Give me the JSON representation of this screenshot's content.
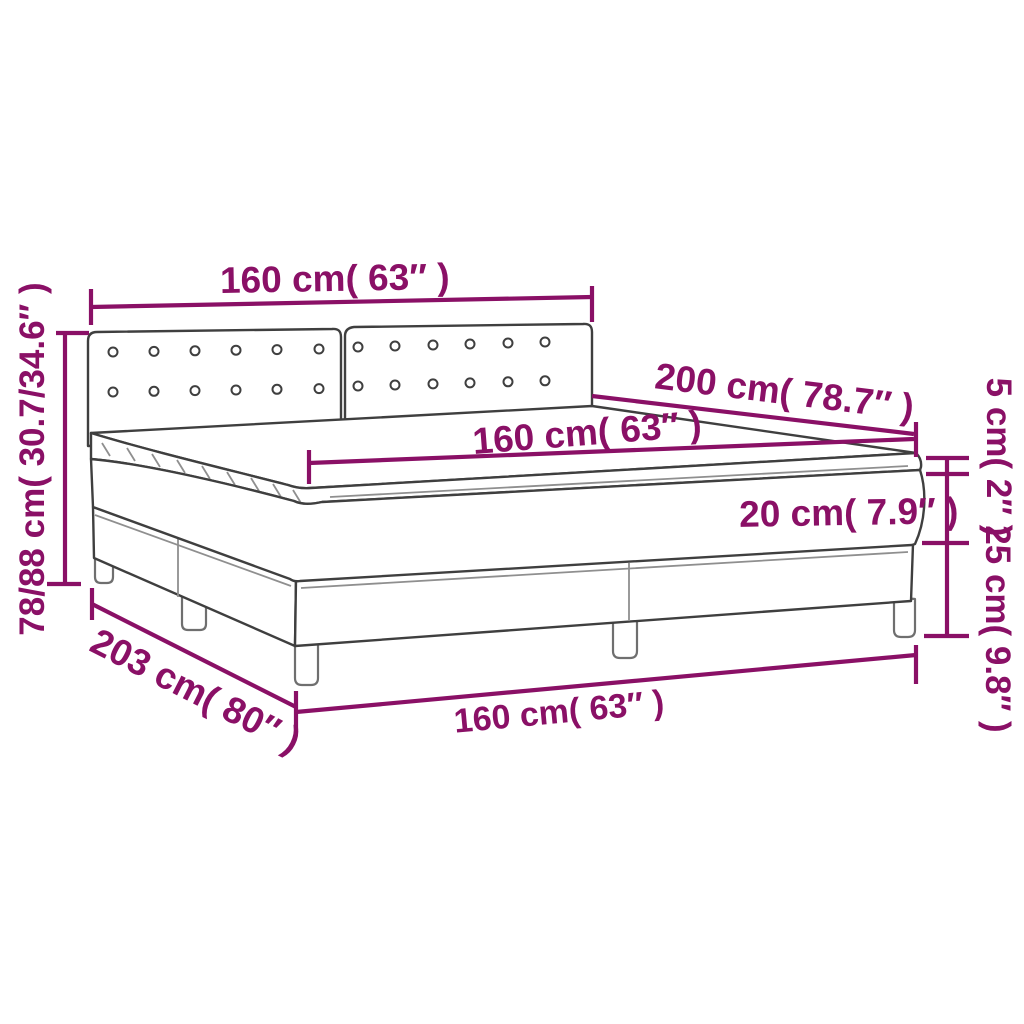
{
  "diagram": {
    "type": "product-dimension-diagram",
    "subject": "box spring bed with two tufted headboard panels, mattress topper, mattress and box-spring base on wooden legs",
    "colors": {
      "accent": "#8A1066",
      "outline": "#3F3F3F",
      "secondary_line": "#8F8F8F",
      "background": "#FFFFFF"
    },
    "dimensions": {
      "headboard_width": "160 cm( 63″ )",
      "bed_length": "200 cm( 78.7″ )",
      "mattress_width": "160 cm( 63″ )",
      "mattress_height": "20 cm( 7.9″ )",
      "topper_height": "5 cm( 2″ )",
      "base_height": "25 cm( 9.8″ )",
      "total_height": "78/88 cm( 30.7/34.6″ )",
      "frame_length": "203 cm( 80″ )",
      "frame_width": "160 cm( 63″ )"
    }
  }
}
